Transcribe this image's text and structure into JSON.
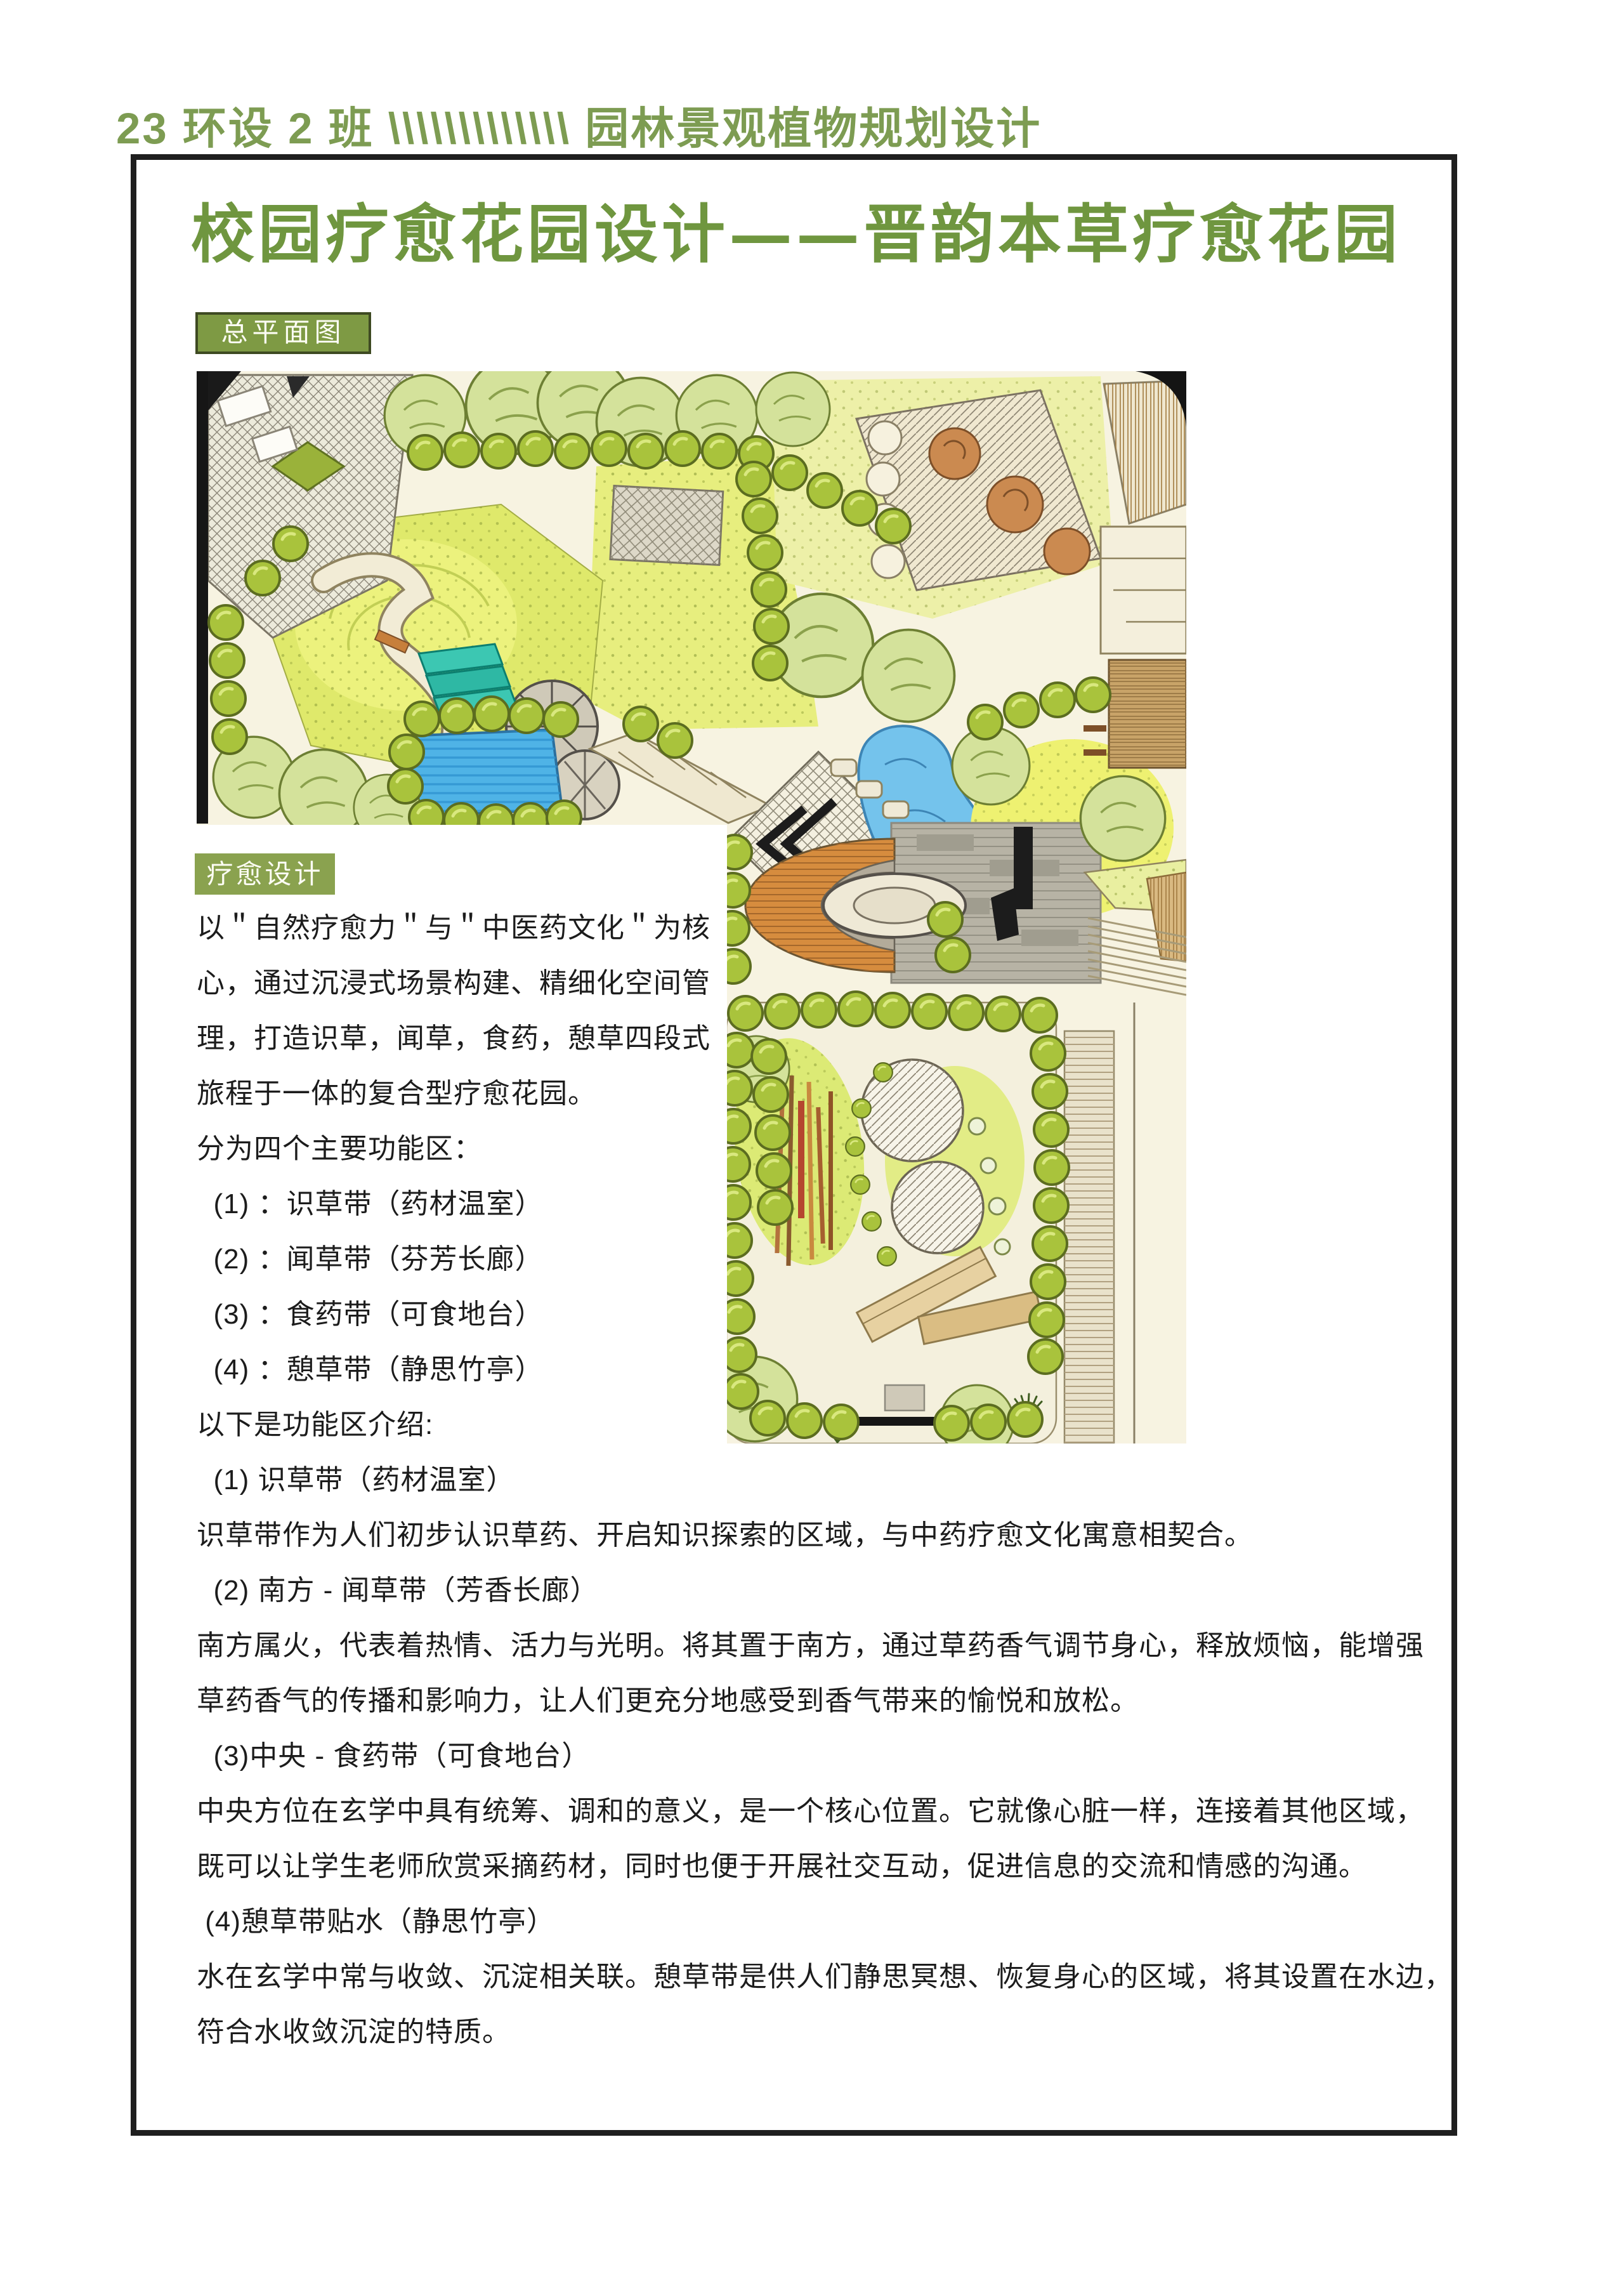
{
  "page": {
    "header": "23 环设 2 班 \\\\\\\\\\\\\\\\\\\\\\\\\\ 园林景观植物规划设计",
    "title": "校园疗愈花园设计——晋韵本草疗愈花园",
    "section_labels": {
      "master_plan": "总平面图",
      "healing_design": "疗愈设计"
    },
    "body_lines": [
      "以＂自然疗愈力＂与＂中医药文化＂为核",
      "心，通过沉浸式场景构建、精细化空间管",
      "理，打造识草，闻草，食药，憩草四段式",
      "旅程于一体的复合型疗愈花园。",
      "分为四个主要功能区：",
      "  (1) ：识草带（药材温室）",
      "  (2) ：闻草带（芬芳长廊）",
      "  (3) ：食药带（可食地台）",
      "  (4) ：憩草带（静思竹亭）",
      "以下是功能区介绍:",
      "  (1) 识草带（药材温室）",
      "识草带作为人们初步认识草药、开启知识探索的区域，与中药疗愈文化寓意相契合。",
      "  (2) 南方 - 闻草带（芳香长廊）",
      "南方属火，代表着热情、活力与光明。将其置于南方，通过草药香气调节身心，释放烦恼，能增强",
      "草药香气的传播和影响力，让人们更充分地感受到香气带来的愉悦和放松。",
      "  (3)中央 - 食药带（可食地台）",
      "中央方位在玄学中具有统筹、调和的意义，是一个核心位置。它就像心脏一样，连接着其他区域，",
      "既可以让学生老师欣赏采摘药材，同时也便于开展社交互动，促进信息的交流和情感的沟通。",
      " (4)憩草带贴水（静思竹亭）",
      "水在玄学中常与收敛、沉淀相关联。憩草带是供人们静思冥想、恢复身心的区域，将其设置在水边，",
      "符合水收敛沉淀的特质。"
    ],
    "colors": {
      "accent_green": "#7d9c52",
      "title_green": "#6f963f",
      "label_bg": "#7e9a44",
      "label2_bg": "#8aa24f",
      "label_border": "#3e4a22",
      "text_color": "#1c1c1c",
      "box_border": "#1f1f1f"
    }
  }
}
